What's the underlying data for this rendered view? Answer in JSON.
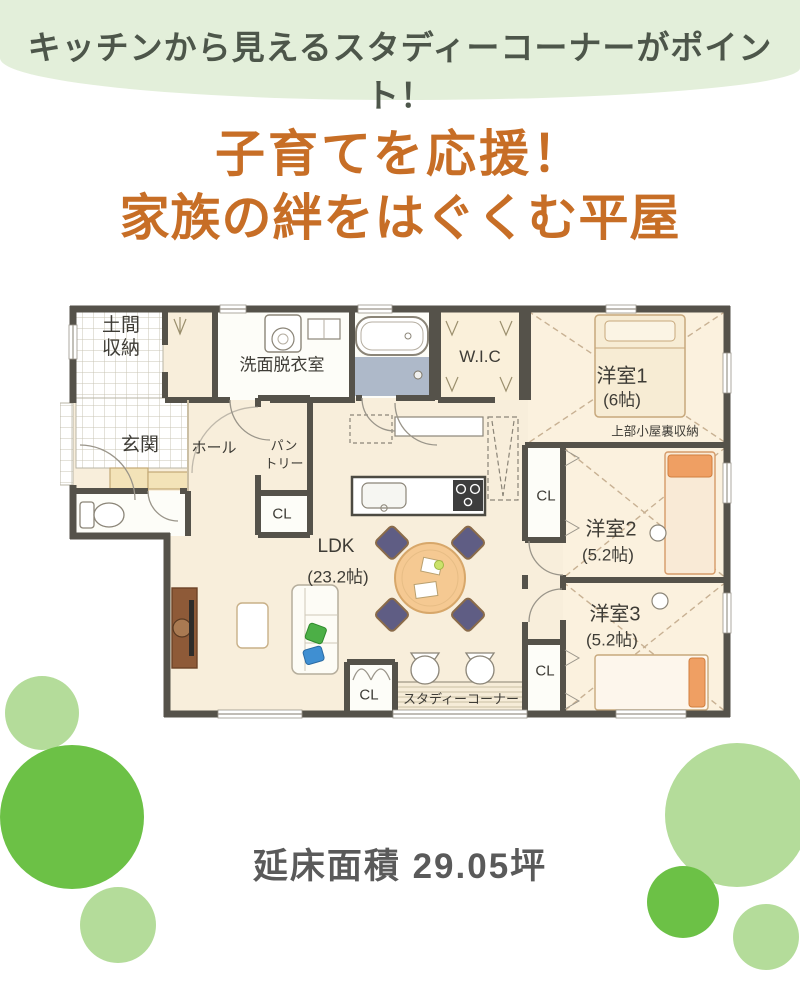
{
  "banner": {
    "text": "キッチンから見えるスタディーコーナーがポイント！"
  },
  "title": {
    "line1": "子育てを応援！",
    "line2": "家族の絆をはぐくむ平屋"
  },
  "floor_plan": {
    "rooms": {
      "doma_line1": "土間",
      "doma_line2": "収納",
      "genkan": "玄関",
      "hall": "ホール",
      "washroom": "洗面脱衣室",
      "pantry_line1": "パン",
      "pantry_line2": "トリー",
      "wic": "W.I.C",
      "bedroom1": "洋室1",
      "bedroom1_size": "(6帖)",
      "attic_note": "上部小屋裏収納",
      "bedroom2": "洋室2",
      "bedroom2_size": "(5.2帖)",
      "bedroom3": "洋室3",
      "bedroom3_size": "(5.2帖)",
      "ldk": "LDK",
      "ldk_size": "(23.2帖)",
      "study_corner": "スタディーコーナー"
    },
    "closet_labels": [
      "CL",
      "CL",
      "CL",
      "CL"
    ]
  },
  "footer": {
    "area_text": "延床面積 29.05坪"
  },
  "colors": {
    "banner_bg": "#e3efda",
    "title_orange": "#c76e26",
    "circle_solid_green": "#6cc146",
    "circle_light_green": "#b4dc9a",
    "wall": "#55524a",
    "floor_beige": "#f8eedb"
  }
}
